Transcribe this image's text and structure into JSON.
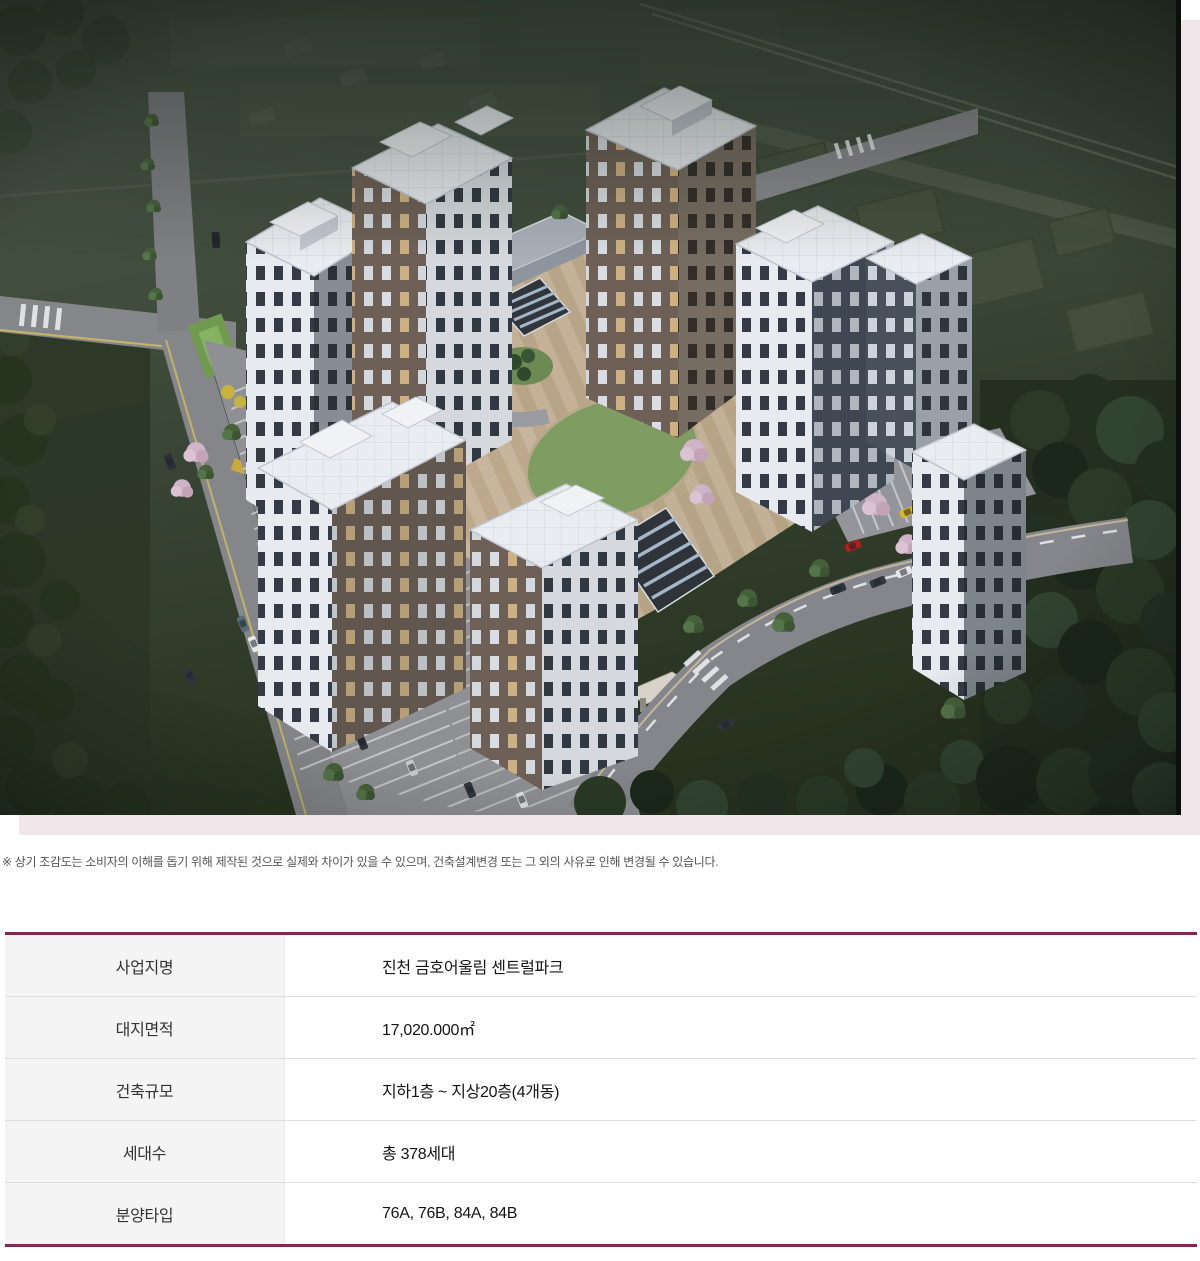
{
  "hero": {
    "illustration": "aerial-bird-eye-render-of-apartment-complex"
  },
  "disclaimer": "※ 상기 조감도는 소비자의 이해를 돕기 위해 제작된 것으로 실제와 차이가 있을 수 있으며, 건축설계변경 또는 그 외의 사유로 인해 변경될 수 있습니다.",
  "table": {
    "rows": [
      {
        "label": "사업지명",
        "value": "진천 금호어울림 센트럴파크"
      },
      {
        "label": "대지면적",
        "value": "17,020.000㎡"
      },
      {
        "label": "건축규모",
        "value": "지하1층 ~ 지상20층(4개동)"
      },
      {
        "label": "세대수",
        "value": "총 378세대"
      },
      {
        "label": "분양타입",
        "value": "76A, 76B, 84A, 84B"
      }
    ]
  },
  "colors": {
    "accent_maroon": "#822a4e",
    "backdrop_pink": "#f0e5e9",
    "label_bg": "#f4f4f4"
  }
}
